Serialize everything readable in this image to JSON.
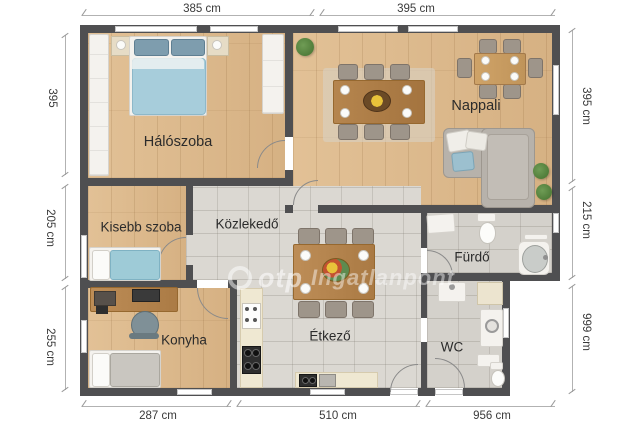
{
  "watermark": {
    "brand": "otp",
    "name": "Ingatlanpont"
  },
  "rooms": {
    "haloszoba": "Hálószoba",
    "nappali": "Nappali",
    "kisebb_szoba": "Kisebb szoba",
    "kozlekedo": "Közlekedő",
    "konyha": "Konyha",
    "etkezo": "Étkező",
    "furdo": "Fürdő",
    "wc": "WC"
  },
  "dimensions": {
    "top": [
      "385 cm",
      "395 cm"
    ],
    "bottom": [
      "287 cm",
      "510 cm",
      "956 cm"
    ],
    "left": [
      "395",
      "205 cm",
      "255 cm"
    ],
    "right": [
      "395 cm",
      "215 cm",
      "999 cm"
    ]
  },
  "colors": {
    "wall": "#4f4f51",
    "wood_floor": "#ddbb8e",
    "tile_floor": "#dbd8d2",
    "bed_blue": "#a7cddb",
    "table_wood": "#b5854e",
    "sofa_gray": "#b7b2ab",
    "dimension_text": "#3a3a3a"
  }
}
